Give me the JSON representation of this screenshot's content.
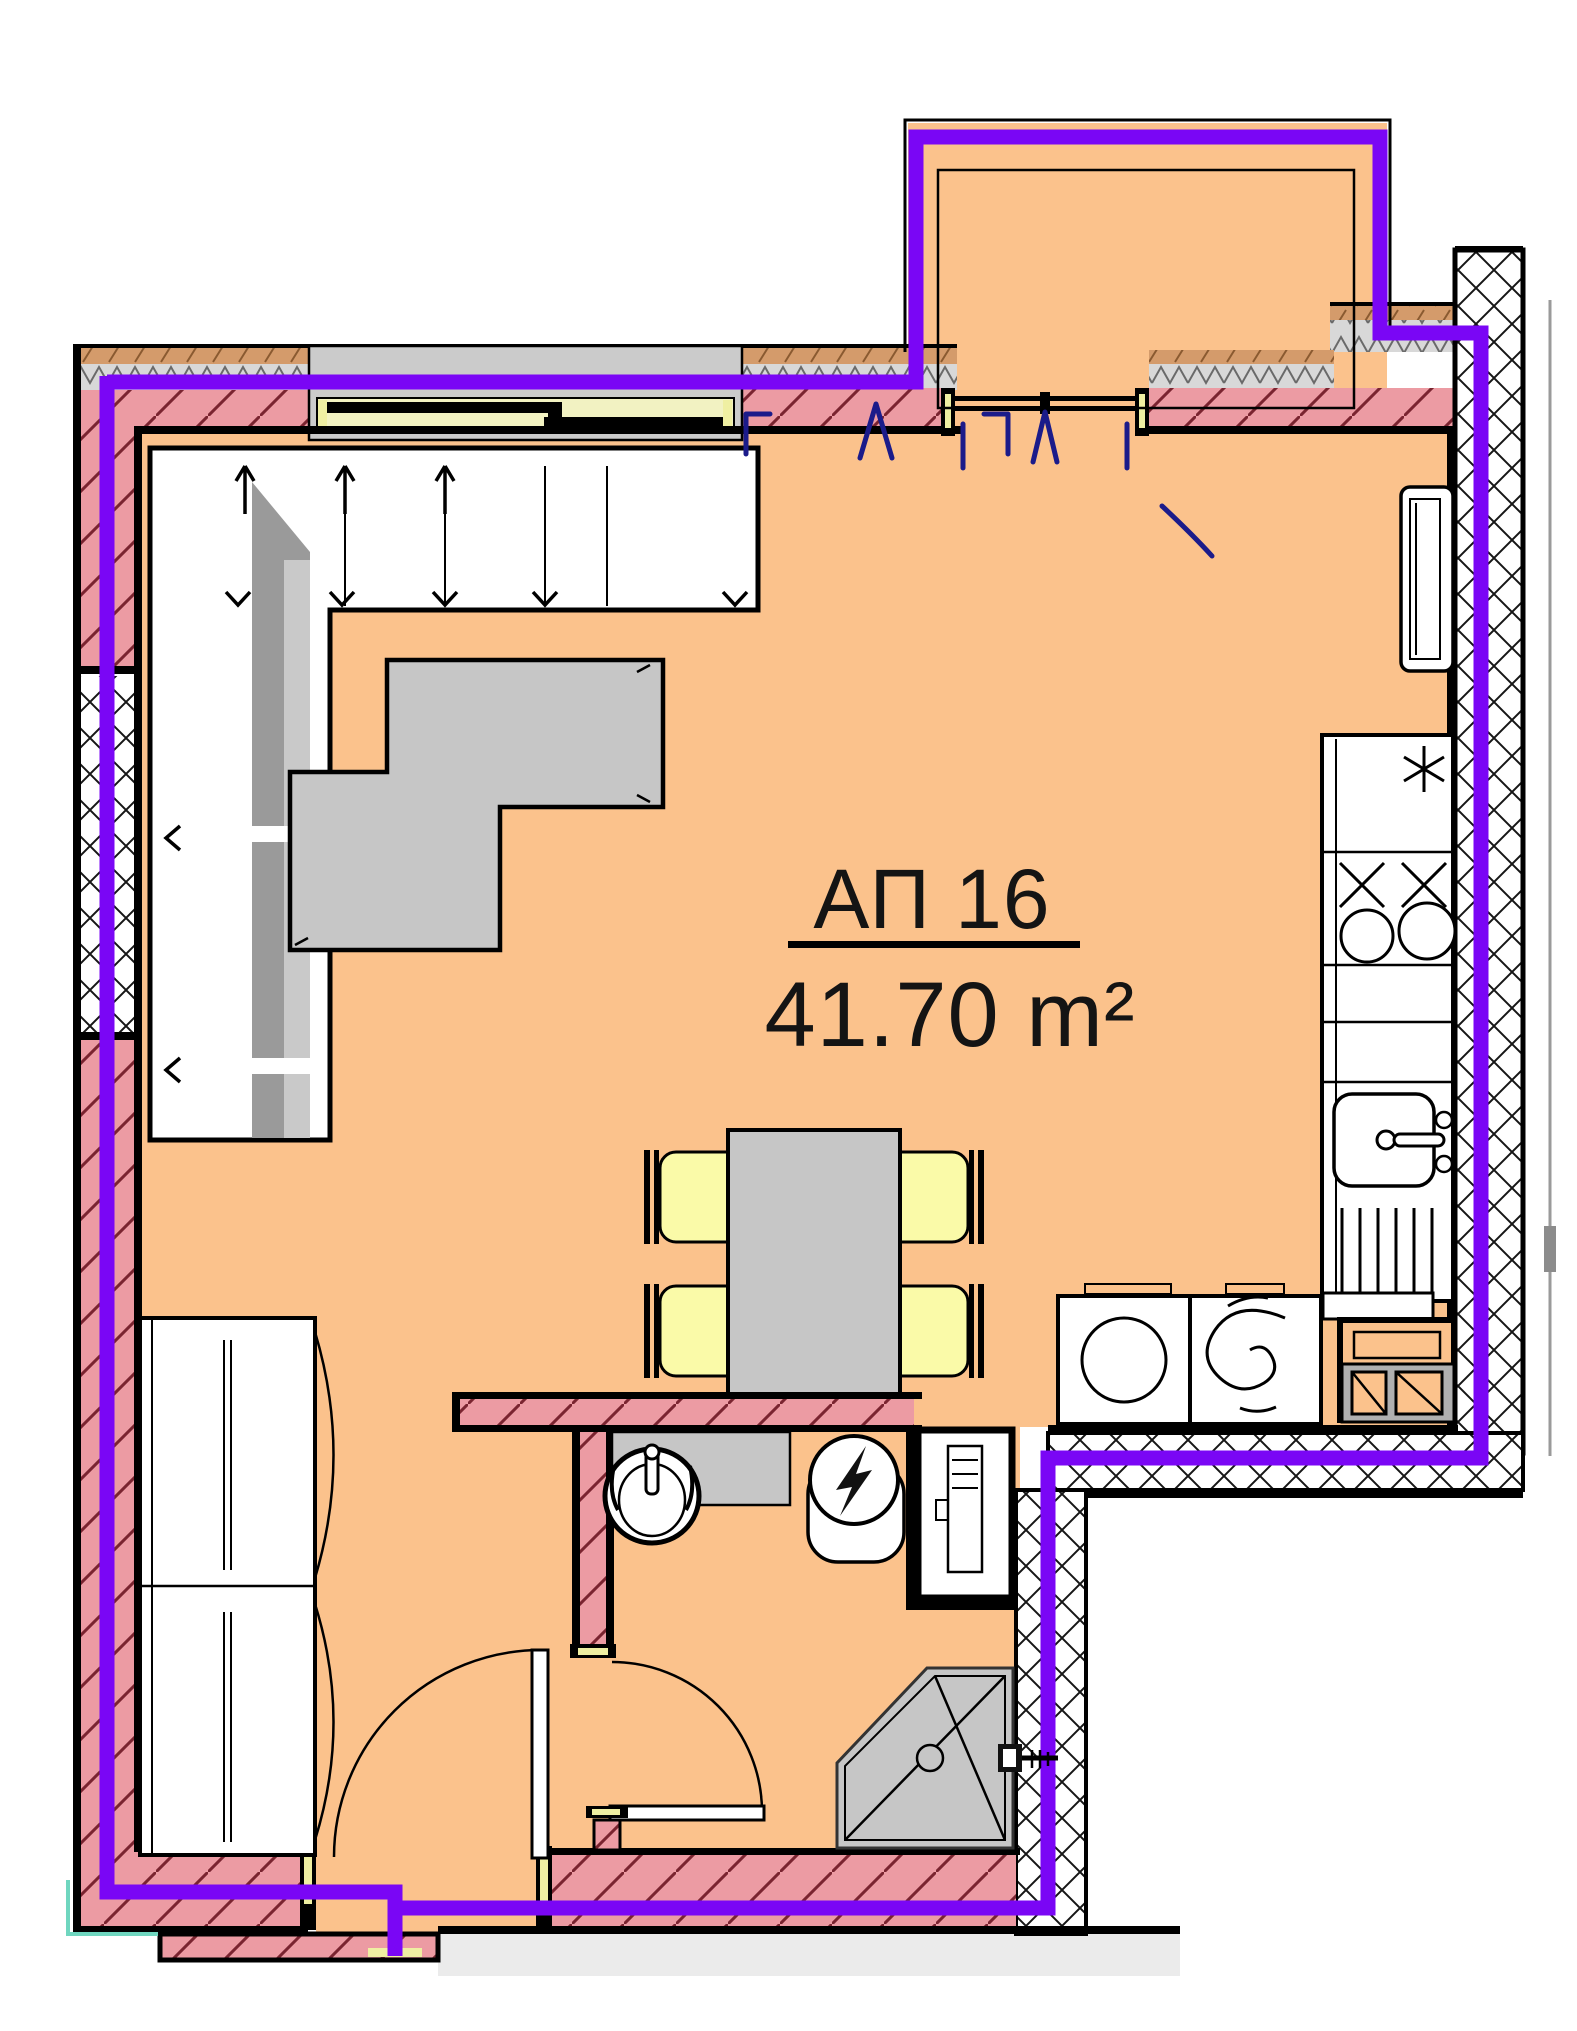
{
  "colors": {
    "floor": "#FBC28C",
    "wall-pink": "#EC9BA3",
    "wall-hatch": "#7A2430",
    "boundary": "#7A06F5",
    "door-swing": "#1B1B8A",
    "furniture-gray": "#C6C6C6",
    "furniture-gray-dark": "#9A9A9A",
    "chair-yellow": "#FAFAA8",
    "glass-yellow": "#F2F2C2",
    "threshold-yellow": "#EFEFA2",
    "brick-tan": "#D49B6B",
    "batt-gray": "#D8D8D8",
    "exterior-gray": "#EBEBEB",
    "accent-teal": "#6FD6BF",
    "line-black": "#000000",
    "white": "#FFFFFF"
  },
  "plan": {
    "apartment_label": "АП 16",
    "area_label": "41.70 m²",
    "rooms": [
      {
        "name": "living-dining-kitchen"
      },
      {
        "name": "bathroom"
      },
      {
        "name": "balcony"
      },
      {
        "name": "entry"
      }
    ],
    "furniture": [
      "corner-sofa",
      "coffee-table",
      "dining-table",
      "dining-chairs-x4",
      "wardrobe",
      "radiator",
      "kitchen-counter",
      "cooktop",
      "kitchen-sink",
      "washing-machine",
      "dryer",
      "service-shaft"
    ],
    "fixtures": [
      "washbasin",
      "toilet",
      "water-heater",
      "pipe-chase",
      "shower"
    ],
    "openings": [
      "entry-door",
      "bathroom-door",
      "balcony-french-door",
      "window"
    ]
  }
}
